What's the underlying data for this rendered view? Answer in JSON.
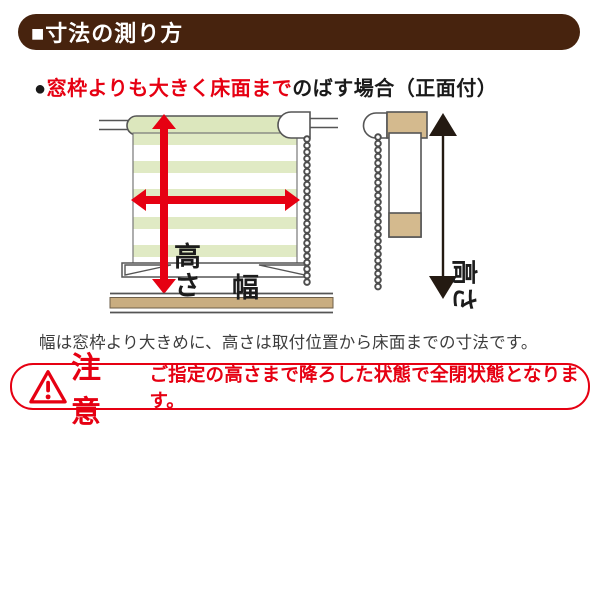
{
  "header": {
    "title": "■寸法の測り方"
  },
  "subtitle": {
    "bullet": "●",
    "highlight": "窓枠よりも大きく床面まで",
    "rest": "のばす場合（正面付）"
  },
  "diagram": {
    "front_view": {
      "height_label": "高さ",
      "width_label": "幅"
    },
    "side_view": {
      "height_label": "高さ"
    }
  },
  "caption": "幅は窓枠より大きめに、高さは取付位置から床面までの寸法です。",
  "warning": {
    "label": "注意",
    "message": "ご指定の高さまで降ろした状態で全閉状態となります。"
  },
  "colors": {
    "header_brown": "#47230e",
    "accent_red": "#e60012",
    "stripe_green": "#e0eac4",
    "roller_green": "#dce7bd",
    "frame_tan": "#d4ba8e",
    "floor_tan": "#c9ad80",
    "outline_gray": "#555555",
    "arrow_black": "#241a12"
  }
}
